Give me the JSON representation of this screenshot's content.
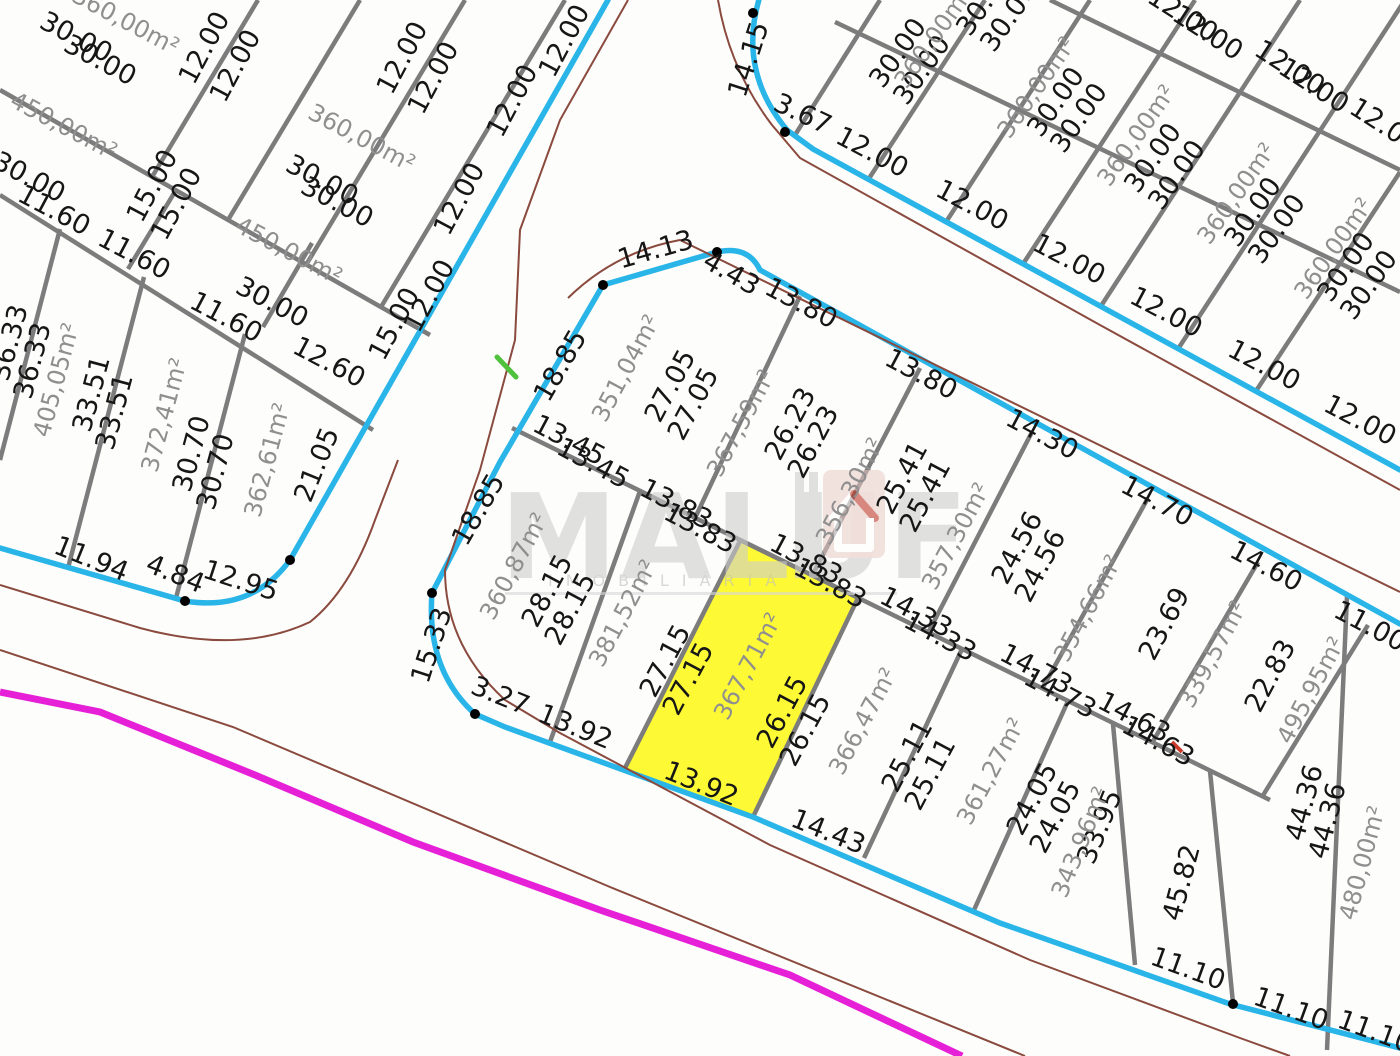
{
  "watermark": {
    "brand": "MALUF",
    "subtitle": "IMOBILIÁRIA",
    "icon": "house-icon"
  },
  "map": {
    "colors": {
      "background": "#fdfdfc",
      "block_boundary": "#2ab5e8",
      "lot_line": "#7c7c7c",
      "road_center": "#8a4a3e",
      "boundary_road": "#e620d6",
      "highlight": "#fdf935",
      "dim_text": "#161616",
      "area_text": "#8f8f8f",
      "vertex_dot": "#000000",
      "green_mark": "#4fc13c",
      "red_mark": "#cc3b2b"
    },
    "highlighted_lot": {
      "area_label": "367,71m²",
      "back": "13.83",
      "front": "13.92",
      "left_side": "27.15",
      "right_side": "26.15",
      "points": "740,541 858,598 753,817 625,768"
    },
    "block_boundaries": [
      "M 0 548 L 185 601 Q 252 612 290 560 L 608 0",
      "M 760 -4 Q 737 70 787 130 L 813 149 L 1400 470",
      "M 432 593 L 500 462 L 603 285 L 717 252 Q 748 245 760 270 L 1400 624",
      "M 432 593 Q 426 670 475 714 L 505 727 L 753 817 L 1000 923 L 1230 1004 L 1400 1048"
    ],
    "lot_lines": [
      "M 0 90 L 430 335",
      "M 0 195 L 373 430",
      "M 258 0 L 152 177",
      "M 360 0 L 228 220",
      "M 465 0 L 306 265",
      "M 565 0 L 381 307",
      "M 176 190 L 128 269",
      "M 312 243 L 263 327",
      "M 60 229 L 0 460",
      "M 144 277 L 68 568",
      "M 245 334 L 176 598",
      "M 1050 0 L 1400 170",
      "M 835 22 L 1400 292",
      "M 880 0 L 795 135",
      "M 985 0 L 868 180",
      "M 1090 0 L 946 222",
      "M 1195 0 L 1023 264",
      "M 1300 0 L 1101 306",
      "M 1405 0 L 1178 349",
      "M 1400 172 L 1256 391",
      "M 512 428 L 1270 800",
      "M 800 296 L 695 518",
      "M 920 368 L 812 576",
      "M 1032 432 L 928 633",
      "M 1148 498 L 1042 689",
      "M 1258 562 L 1152 743",
      "M 1368 625 L 1262 797",
      "M 640 491 L 550 742",
      "M 740 541 L 625 768",
      "M 858 598 L 753 817",
      "M 962 649 L 864 858",
      "M 1068 701 L 974 910",
      "M 1113 724 L 1135 965",
      "M 1210 771 L 1233 1003",
      "M 1347 596 L 1327 1050"
    ],
    "road_centerlines": [
      "M 628 0 L 560 120 L 520 230 L 515 340 L 480 470 L 445 570 Q 445 645 505 700 L 560 733 L 770 845 L 1030 960 L 1240 1038 L 1290 1056",
      "M 0 585 L 140 628 Q 240 655 310 622 Q 350 590 375 520 L 398 460",
      "M 0 650 L 233 727 L 610 887 L 1025 1056",
      "M 718 0 Q 730 70 772 125 L 800 158 L 1100 325 L 1400 490",
      "M 568 298 Q 615 252 680 240 L 1400 592"
    ],
    "boundary_road": "M 0 692 L 100 712 L 255 775 L 413 842 L 600 910 L 790 975 L 962 1056",
    "marks": {
      "green": "M 497 357 L 516 377",
      "red": "M 1172 742 L 1182 752"
    },
    "vertex_dots": [
      [
        185,
        601
      ],
      [
        290,
        560
      ],
      [
        603,
        285
      ],
      [
        717,
        252
      ],
      [
        432,
        593
      ],
      [
        475,
        714
      ],
      [
        753,
        13
      ],
      [
        785,
        132
      ],
      [
        1233,
        1004
      ]
    ],
    "labels": [
      [
        "360,00m²",
        122,
        28,
        28,
        "a"
      ],
      [
        "30.00",
        72,
        45,
        28,
        "d"
      ],
      [
        "30.00",
        96,
        68,
        28,
        "d"
      ],
      [
        "12.00",
        212,
        52,
        -62,
        "d"
      ],
      [
        "12.00",
        243,
        70,
        -62,
        "d"
      ],
      [
        "360,00m²",
        358,
        145,
        28,
        "a"
      ],
      [
        "12.00",
        410,
        62,
        -62,
        "d"
      ],
      [
        "12.00",
        441,
        82,
        -62,
        "d"
      ],
      [
        "30.00",
        318,
        188,
        28,
        "d"
      ],
      [
        "30.00",
        333,
        210,
        28,
        "d"
      ],
      [
        "450,00m²",
        60,
        133,
        28,
        "a"
      ],
      [
        "15.00",
        160,
        190,
        -62,
        "d"
      ],
      [
        "15.00",
        184,
        208,
        -62,
        "d"
      ],
      [
        "30.00",
        25,
        185,
        28,
        "d"
      ],
      [
        "11.60",
        50,
        218,
        28,
        "d"
      ],
      [
        "11.60",
        130,
        262,
        28,
        "d"
      ],
      [
        "450,00m²",
        285,
        258,
        28,
        "a"
      ],
      [
        "11.60",
        222,
        325,
        28,
        "d"
      ],
      [
        "30.00",
        268,
        310,
        28,
        "d"
      ],
      [
        "12.60",
        325,
        370,
        28,
        "d"
      ],
      [
        "15.00",
        402,
        328,
        -62,
        "d"
      ],
      [
        "12.00",
        572,
        45,
        -62,
        "d"
      ],
      [
        "12.00",
        520,
        105,
        -62,
        "d"
      ],
      [
        "12.00",
        467,
        203,
        -62,
        "d"
      ],
      [
        "12.00",
        437,
        300,
        -62,
        "d"
      ],
      [
        "36.33",
        18,
        345,
        -75,
        "d"
      ],
      [
        "36.33",
        41,
        363,
        -75,
        "d"
      ],
      [
        "405,05m²",
        64,
        382,
        -75,
        "a"
      ],
      [
        "33.51",
        100,
        396,
        -75,
        "d"
      ],
      [
        "33.51",
        123,
        414,
        -75,
        "d"
      ],
      [
        "372,41m²",
        172,
        417,
        -75,
        "a"
      ],
      [
        "30.70",
        200,
        456,
        -75,
        "d"
      ],
      [
        "30.70",
        224,
        474,
        -75,
        "d"
      ],
      [
        "362,61m²",
        275,
        462,
        -75,
        "a"
      ],
      [
        "21.05",
        325,
        468,
        -68,
        "d"
      ],
      [
        "11.94",
        88,
        567,
        22,
        "d"
      ],
      [
        "4.84",
        172,
        582,
        22,
        "d"
      ],
      [
        "12.95",
        238,
        589,
        18,
        "d"
      ],
      [
        "14.15",
        757,
        62,
        -72,
        "d"
      ],
      [
        "3.67",
        799,
        122,
        25,
        "d"
      ],
      [
        "12.00",
        868,
        160,
        28,
        "d"
      ],
      [
        "12.00",
        968,
        213,
        28,
        "d"
      ],
      [
        "12.00",
        1065,
        267,
        28,
        "d"
      ],
      [
        "12.00",
        1162,
        320,
        28,
        "d"
      ],
      [
        "12.00",
        1260,
        373,
        28,
        "d"
      ],
      [
        "12.00",
        1356,
        428,
        28,
        "d"
      ],
      [
        "30.00",
        905,
        58,
        -55,
        "d"
      ],
      [
        "30.00",
        929,
        75,
        -55,
        "d"
      ],
      [
        "30.00",
        1063,
        107,
        -55,
        "d"
      ],
      [
        "30.00",
        1086,
        123,
        -55,
        "d"
      ],
      [
        "30.00",
        1160,
        163,
        -55,
        "d"
      ],
      [
        "30.00",
        1184,
        180,
        -55,
        "d"
      ],
      [
        "30.00",
        1260,
        217,
        -55,
        "d"
      ],
      [
        "30.00",
        1284,
        234,
        -55,
        "d"
      ],
      [
        "30.00",
        1353,
        272,
        -55,
        "d"
      ],
      [
        "30.00",
        1376,
        290,
        -55,
        "d"
      ],
      [
        "30.00",
        992,
        6,
        -55,
        "d"
      ],
      [
        "30.00",
        1016,
        22,
        -55,
        "d"
      ],
      [
        "12.00",
        1178,
        22,
        33,
        "d"
      ],
      [
        "12.00",
        1203,
        40,
        33,
        "d"
      ],
      [
        "12.00",
        1285,
        75,
        33,
        "d"
      ],
      [
        "12.00",
        1309,
        93,
        33,
        "d"
      ],
      [
        "12.00",
        1380,
        133,
        33,
        "d"
      ],
      [
        "360,00m²",
        940,
        42,
        -55,
        "a"
      ],
      [
        "360,00m²",
        1043,
        92,
        -55,
        "a"
      ],
      [
        "360,00m²",
        1143,
        140,
        -55,
        "a"
      ],
      [
        "360,00m²",
        1243,
        198,
        -55,
        "a"
      ],
      [
        "360,00m²",
        1340,
        253,
        -55,
        "a"
      ],
      [
        "14.13",
        658,
        258,
        -16,
        "d"
      ],
      [
        "4.43",
        727,
        281,
        30,
        "d"
      ],
      [
        "13.80",
        797,
        311,
        28,
        "d"
      ],
      [
        "13.80",
        917,
        382,
        28,
        "d"
      ],
      [
        "14.30",
        1038,
        442,
        28,
        "d"
      ],
      [
        "14.70",
        1153,
        509,
        28,
        "d"
      ],
      [
        "14.60",
        1262,
        574,
        28,
        "d"
      ],
      [
        "11.00",
        1366,
        634,
        28,
        "d"
      ],
      [
        "18.85",
        568,
        370,
        -60,
        "d"
      ],
      [
        "18.85",
        486,
        514,
        -60,
        "d"
      ],
      [
        "15.33",
        440,
        648,
        -72,
        "d"
      ],
      [
        "3.27",
        497,
        704,
        22,
        "d"
      ],
      [
        "351,04m²",
        633,
        372,
        -62,
        "a"
      ],
      [
        "27.05",
        678,
        390,
        -62,
        "d"
      ],
      [
        "27.05",
        701,
        408,
        -62,
        "d"
      ],
      [
        "367,59m²",
        748,
        427,
        -62,
        "a"
      ],
      [
        "26.23",
        798,
        428,
        -62,
        "d"
      ],
      [
        "26.23",
        821,
        446,
        -62,
        "d"
      ],
      [
        "356,30m²",
        857,
        495,
        -62,
        "a"
      ],
      [
        "25.41",
        910,
        482,
        -62,
        "d"
      ],
      [
        "25.41",
        933,
        500,
        -62,
        "d"
      ],
      [
        "357,30m²",
        963,
        540,
        -62,
        "a"
      ],
      [
        "24.56",
        1025,
        552,
        -62,
        "d"
      ],
      [
        "24.56",
        1048,
        570,
        -62,
        "d"
      ],
      [
        "354,66m²",
        1095,
        612,
        -62,
        "a"
      ],
      [
        "23.69",
        1172,
        628,
        -62,
        "d"
      ],
      [
        "339,57m²",
        1220,
        658,
        -62,
        "a"
      ],
      [
        "22.83",
        1278,
        680,
        -62,
        "d"
      ],
      [
        "495,95m²",
        1318,
        694,
        -62,
        "a"
      ],
      [
        "13.45",
        565,
        448,
        28,
        "d"
      ],
      [
        "13.45",
        589,
        471,
        28,
        "d"
      ],
      [
        "13.83",
        672,
        512,
        28,
        "d"
      ],
      [
        "13.83",
        696,
        536,
        28,
        "d"
      ],
      [
        "13.83",
        802,
        567,
        28,
        "d"
      ],
      [
        "13.83",
        826,
        591,
        28,
        "d"
      ],
      [
        "14.33",
        912,
        620,
        28,
        "d"
      ],
      [
        "14.33",
        936,
        644,
        28,
        "d"
      ],
      [
        "14.73",
        1032,
        677,
        28,
        "d"
      ],
      [
        "14.73",
        1056,
        701,
        28,
        "d"
      ],
      [
        "14.63",
        1130,
        725,
        28,
        "d"
      ],
      [
        "14.63",
        1154,
        749,
        28,
        "d"
      ],
      [
        "360,87m²",
        521,
        570,
        -62,
        "a"
      ],
      [
        "28.15",
        555,
        595,
        -62,
        "d"
      ],
      [
        "28.15",
        578,
        613,
        -62,
        "d"
      ],
      [
        "381,52m²",
        630,
        617,
        -62,
        "a"
      ],
      [
        "27.15",
        673,
        665,
        -62,
        "d"
      ],
      [
        "27.15",
        696,
        683,
        -62,
        "d"
      ],
      [
        "367,71m²",
        755,
        670,
        -62,
        "a"
      ],
      [
        "26.15",
        790,
        716,
        -62,
        "d"
      ],
      [
        "26.15",
        813,
        734,
        -62,
        "d"
      ],
      [
        "366,47m²",
        870,
        725,
        -62,
        "a"
      ],
      [
        "25.11",
        915,
        760,
        -62,
        "d"
      ],
      [
        "25.11",
        938,
        778,
        -62,
        "d"
      ],
      [
        "361,27m²",
        998,
        775,
        -62,
        "a"
      ],
      [
        "24.05",
        1040,
        803,
        -62,
        "d"
      ],
      [
        "24.05",
        1063,
        821,
        -62,
        "d"
      ],
      [
        "33.95",
        1108,
        830,
        -68,
        "d"
      ],
      [
        "343,96m²",
        1088,
        845,
        -68,
        "a"
      ],
      [
        "45.82",
        1190,
        885,
        -75,
        "d"
      ],
      [
        "44.36",
        1313,
        805,
        -75,
        "d"
      ],
      [
        "44.36",
        1336,
        823,
        -75,
        "d"
      ],
      [
        "480,00m²",
        1370,
        865,
        -75,
        "a"
      ],
      [
        "13.92",
        572,
        735,
        22,
        "d"
      ],
      [
        "13.92",
        698,
        792,
        22,
        "d"
      ],
      [
        "14.43",
        825,
        840,
        22,
        "d"
      ],
      [
        "11.10",
        1185,
        977,
        20,
        "d"
      ],
      [
        "11.10",
        1288,
        1017,
        20,
        "d"
      ],
      [
        "11.10",
        1372,
        1040,
        20,
        "d"
      ]
    ]
  }
}
